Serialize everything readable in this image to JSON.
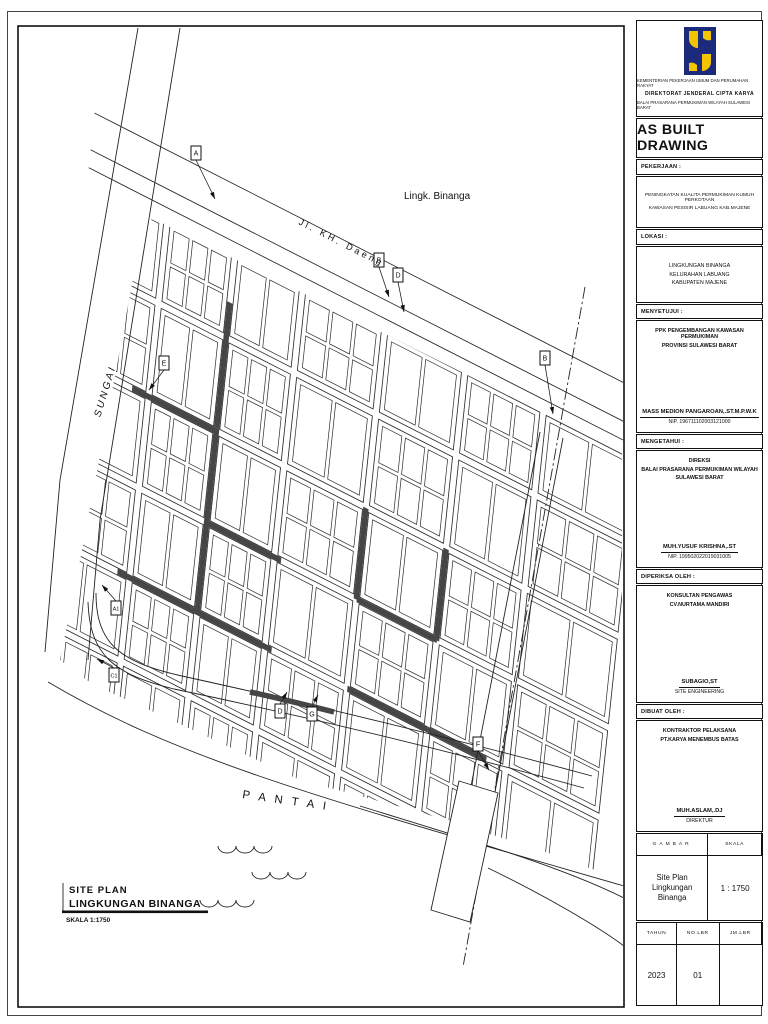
{
  "titleblock": {
    "ministry_lines": [
      "KEMENTERIAN PEKERJAAN UMUM DAN PERUMAHAN RAKYAT",
      "DIREKTORAT JENDERAL CIPTA KARYA",
      "BALAI PRASARANA PERMUKIMAN WILAYAH SULAWESI BARAT"
    ],
    "as_built": "AS BUILT DRAWING",
    "pekerjaan_label": "PEKERJAAN :",
    "pekerjaan_lines": [
      "PENINGKATAN KUALITA PERMUKIMAN KUMUH PERKOTAAN",
      "KAWASAN PESISIR LABUANG KAB.MAJENE"
    ],
    "lokasi_label": "LOKASI  :",
    "lokasi_lines": [
      "LINGKUNGAN BINANGA",
      "KELURAHAN LABUANG",
      "KABUPATEN MAJENE"
    ],
    "menyetujui_label": "MENYETUJUI :",
    "menyetujui_lines": [
      "PPK PENGEMBANGAN KAWASAN  PERMUKIMAN",
      "PROVINSI SULAWESI BARAT"
    ],
    "menyetujui_name": "MASS MEDION PANGAROAN,.ST.M.P.W.K",
    "menyetujui_nip": "NIP. 196711102003121000",
    "mengetahui_label": "MENGETAHUI :",
    "mengetahui_lines": [
      "DIREKSI",
      "BALAI PRASARANA PERMUKIMAN WILAYAH",
      "SULAWESI BARAT"
    ],
    "mengetahui_name": "MUH.YUSUF KRISHNA,.ST",
    "mengetahui_nip": "NIP. 199502022019031005",
    "diperiksa_label": "DIPERIKSA OLEH :",
    "diperiksa_lines": [
      "KONSULTAN PENGAWAS",
      "CV.NURTAMA MANDIRI"
    ],
    "diperiksa_name": "SUBAGIO,ST",
    "diperiksa_role": "SITE ENGINEERING",
    "dibuat_label": "DIBUAT OLEH :",
    "dibuat_lines": [
      "KONTRAKTOR PELAKSANA",
      "PT.KARYA MENEMBUS BATAS"
    ],
    "dibuat_name": "MUH.ASLAM,.DJ",
    "dibuat_role": "DIREKTUR",
    "gambar_header": "GAMBAR",
    "skala_header": "SKALA",
    "gambar_value_line1": "Site Plan Lingkungan",
    "gambar_value_line2": "Binanga",
    "skala_value": "1 : 1750",
    "tahun_header": "TAHUN",
    "no_lbr_header": "NO.LBR",
    "jm_lbr_header": "JM.LBR",
    "tahun_value": "2023",
    "no_lbr_value": "01",
    "jm_lbr_value": ""
  },
  "map": {
    "labels": {
      "street": "Jl.  KH.  Daeng",
      "area": "Lingk. Binanga",
      "river": "SUNGAI",
      "beach": "P A N T A I"
    },
    "legend": {
      "title_line1": "SITE PLAN",
      "title_line2": "LINGKUNGAN BINANGA",
      "scale": "SKALA  1:1750"
    },
    "markers": [
      {
        "label": "A",
        "x": 196,
        "y": 153,
        "ax": 215,
        "ay": 199
      },
      {
        "label": "B",
        "x": 379,
        "y": 260,
        "ax": 389,
        "ay": 297
      },
      {
        "label": "D",
        "x": 398,
        "y": 275,
        "ax": 404,
        "ay": 312
      },
      {
        "label": "E",
        "x": 164,
        "y": 363,
        "ax": 149,
        "ay": 390
      },
      {
        "label": "B",
        "x": 545,
        "y": 358,
        "ax": 553,
        "ay": 414
      },
      {
        "label": "A1",
        "x": 116,
        "y": 608,
        "ax": 102,
        "ay": 585
      },
      {
        "label": "C1",
        "x": 114,
        "y": 675,
        "ax": 97,
        "ay": 659
      },
      {
        "label": "D",
        "x": 280,
        "y": 711,
        "ax": 287,
        "ay": 692
      },
      {
        "label": "G",
        "x": 312,
        "y": 714,
        "ax": 318,
        "ay": 695
      },
      {
        "label": "F",
        "x": 478,
        "y": 744,
        "ax": 489,
        "ay": 770
      }
    ],
    "colors": {
      "line": "#222222",
      "dark_street": "#464646",
      "fill": "#ffffff"
    },
    "geometry": {
      "matrix": [
        0.891,
        0.454,
        -0.105,
        0.994,
        103,
        175
      ],
      "u_min": -20,
      "u_max": 600,
      "v_min": 14,
      "v_max": 580,
      "v_streets": [
        70,
        146,
        222,
        314,
        404,
        492
      ],
      "h_streets": [
        92,
        186,
        278,
        368,
        452
      ],
      "street_w": 7,
      "boundary_v": [
        -55,
        -18,
        0
      ],
      "dark": [
        [
          "V",
          146,
          60,
          186
        ],
        [
          "H",
          186,
          55,
          150
        ],
        [
          "V",
          146,
          186,
          372
        ],
        [
          "H",
          368,
          60,
          233
        ],
        [
          "H",
          278,
          150,
          233
        ],
        [
          "V",
          314,
          190,
          282
        ],
        [
          "H",
          278,
          318,
          408
        ],
        [
          "V",
          404,
          190,
          282
        ],
        [
          "H",
          368,
          318,
          408
        ],
        [
          "H",
          368,
          408,
          474
        ]
      ],
      "clip": [
        [
          152,
          218
        ],
        [
          622,
          452
        ],
        [
          622,
          880
        ],
        [
          540,
          850
        ],
        [
          420,
          812
        ],
        [
          300,
          780
        ],
        [
          180,
          724
        ],
        [
          92,
          684
        ],
        [
          60,
          660
        ],
        [
          80,
          560
        ],
        [
          100,
          455
        ],
        [
          118,
          360
        ],
        [
          136,
          262
        ]
      ],
      "river": [
        [
          [
            138,
            28
          ],
          [
            60,
            480
          ],
          [
            45,
            652
          ]
        ],
        [
          [
            180,
            28
          ],
          [
            100,
            520
          ],
          [
            88,
            660
          ]
        ]
      ],
      "coast": [
        "M 48,682 C 180,760 320,798 624,886",
        "M 360,806 C 470,840 560,866 624,898",
        "M 488,868 C 550,898 600,928 624,946"
      ],
      "curve_road": [
        "M 96,593 C 96,644 120,662 182,676 C 300,702 430,732 592,776",
        "M 88,602 C 90,656 114,674 174,689 C 294,714 424,744 584,788"
      ],
      "curve_dark": "M 250,692 C 278,698 306,705 334,712",
      "dashdot": [
        [
          585,
          287
        ],
        [
          463,
          967
        ]
      ],
      "ddroad": [
        [
          [
            540,
            432
          ],
          [
            466,
            812
          ]
        ],
        [
          [
            563,
            438
          ],
          [
            490,
            818
          ]
        ]
      ],
      "jetty": [
        [
          459,
          781
        ],
        [
          498,
          793
        ],
        [
          470,
          922
        ],
        [
          431,
          910
        ]
      ],
      "waves": [
        [
          218,
          846
        ],
        [
          252,
          872
        ],
        [
          200,
          900
        ]
      ]
    }
  }
}
